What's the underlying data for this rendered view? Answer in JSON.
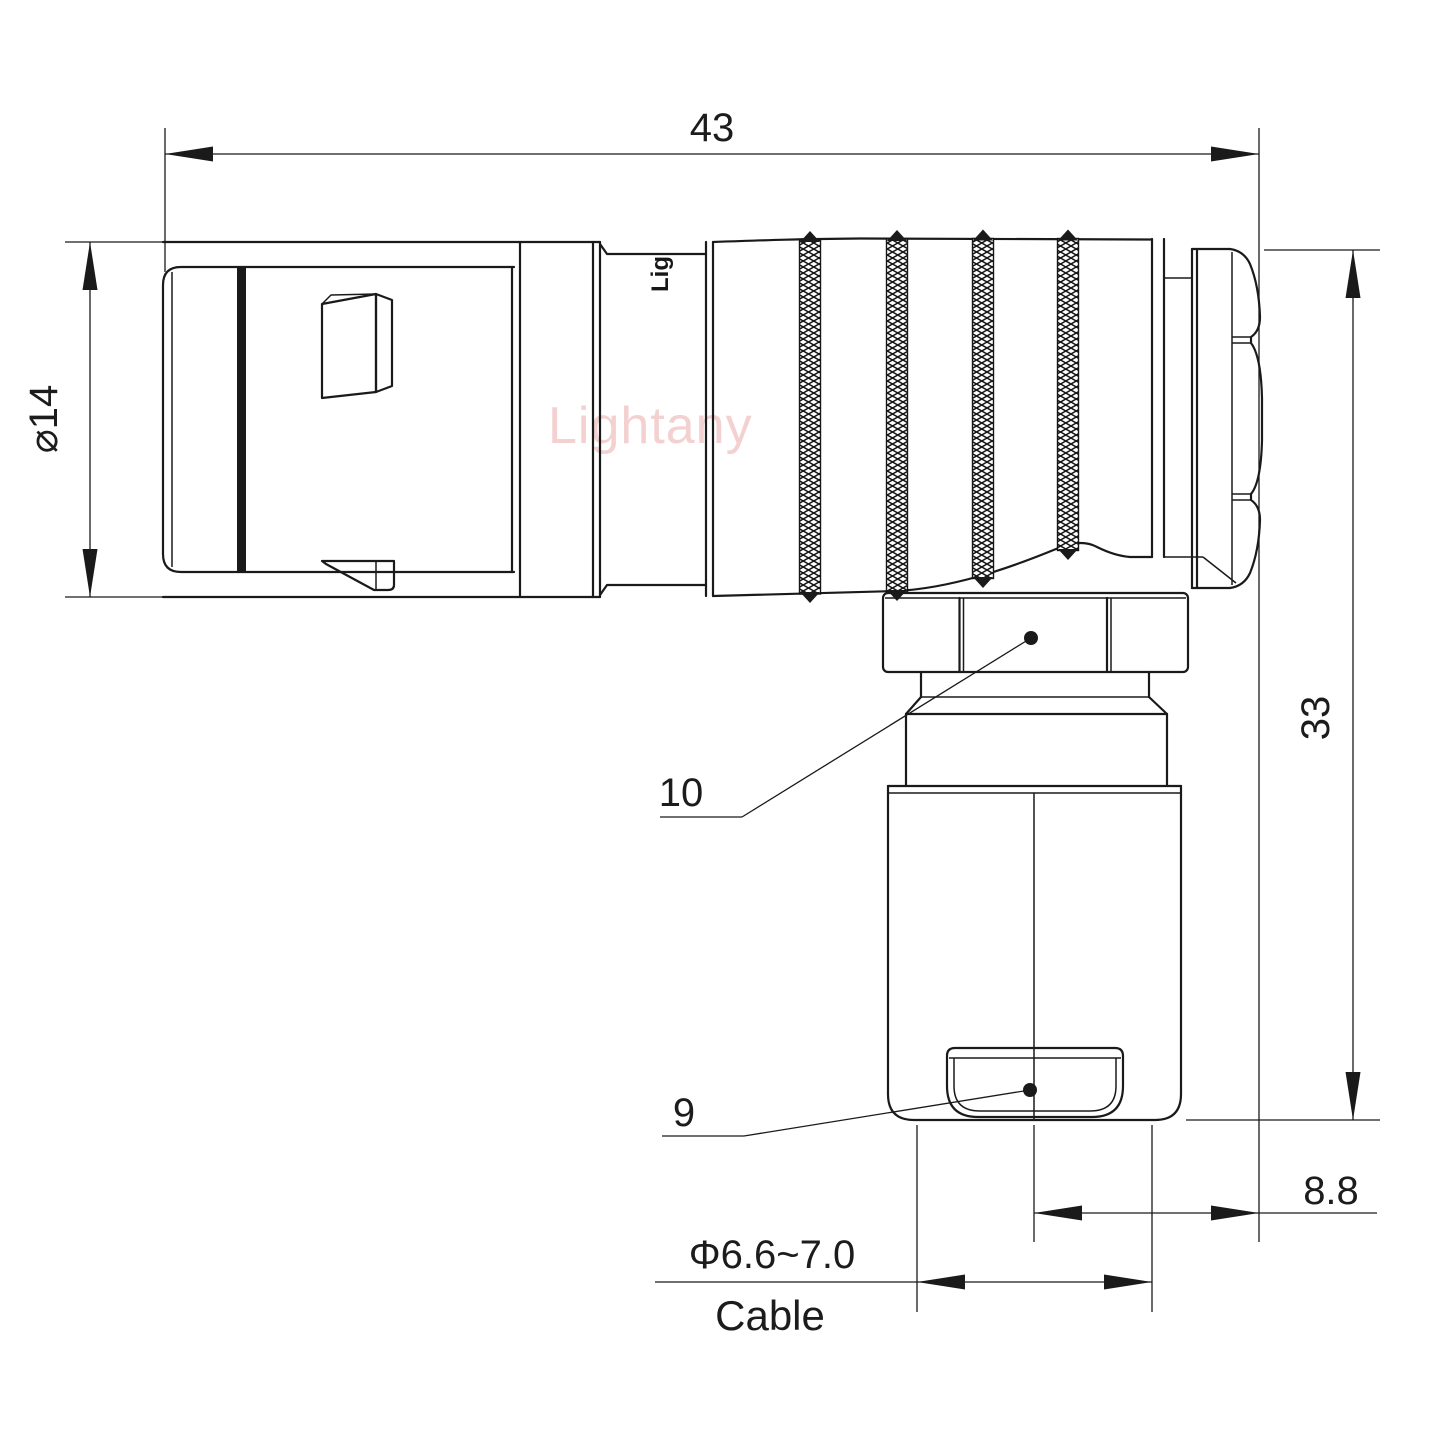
{
  "drawing": {
    "title": "right-angle connector technical drawing",
    "labels": {
      "dim_overall_length": "43",
      "dim_outer_diameter": "⌀14",
      "dim_height": "33",
      "dim_back_offset": "8.8",
      "dim_cable_diameter": "Φ6.6~7.0",
      "dim_cable_caption": "Cable",
      "ref_coupling_nut": "10",
      "ref_cable_clamp": "9",
      "watermark": "Lightany",
      "body_logo": "Lig"
    },
    "colors": {
      "line": "#1a1a1a",
      "text": "#1c1c1c",
      "watermark": "#f2c6c6",
      "background": "#ffffff"
    }
  }
}
